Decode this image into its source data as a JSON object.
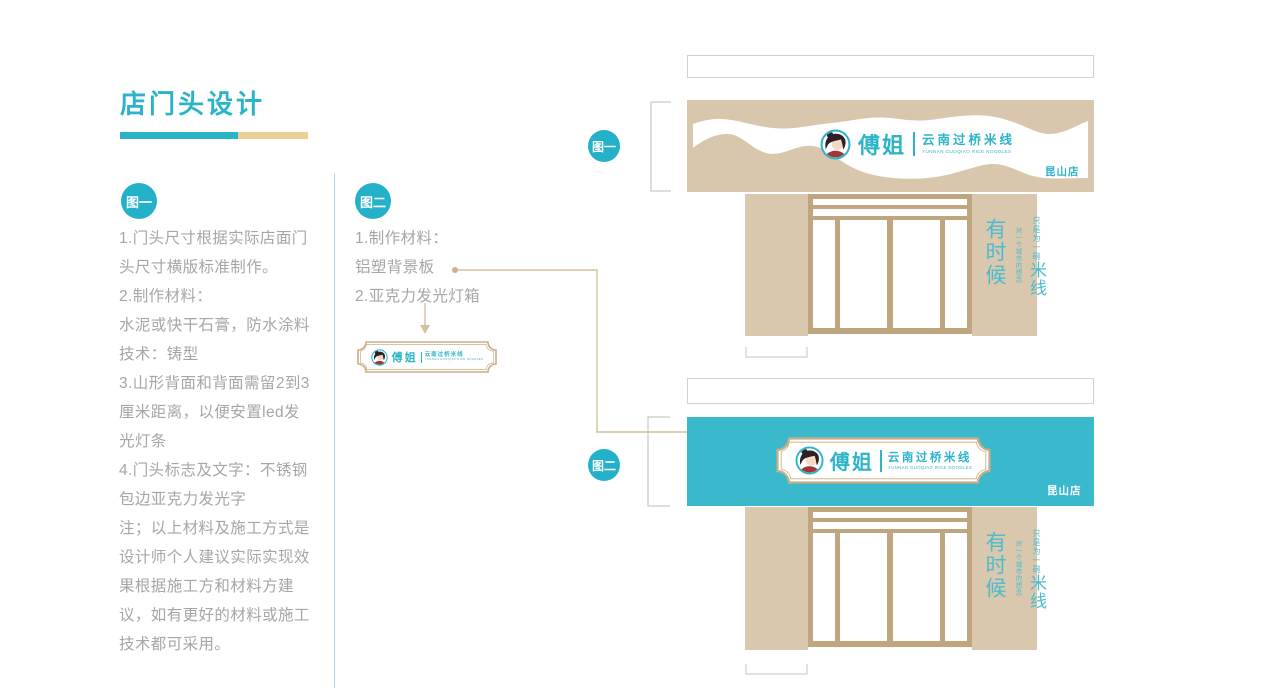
{
  "page": {
    "title": "店门头设计"
  },
  "palette": {
    "teal": "#2db4c9",
    "sign_teal": "#3ab9cd",
    "tan": "#d8c6ad",
    "frame_tan": "#bfa67e",
    "sand": "#ecd093",
    "note_gray": "#a6a6a6",
    "plaque_border": "#c9ad85"
  },
  "figure1": {
    "badge": "图一",
    "notes": "1.门头尺寸根据实际店面门\n头尺寸横版标准制作。\n2.制作材料：\n水泥或快干石膏，防水涂料\n技术：铸型\n3.山形背面和背面需留2到3\n厘米距离，以便安置led发\n光灯条\n4.门头标志及文字：不锈钢\n包边亚克力发光字\n注；以上材料及施工方式是\n设计师个人建议实际实现效\n果根据施工方和材料方建\n议，如有更好的材料或施工\n技术都可采用。"
  },
  "figure2": {
    "badge": "图二",
    "notes": "1.制作材料：\n铝塑背景板\n2.亚克力发光灯箱"
  },
  "brand": {
    "name": "傅姐",
    "tagline": "云南过桥米线",
    "tagline_en": "YUNNAN GUOQIAO RICE NOODLES",
    "store": "昆山店"
  },
  "slogan": {
    "opening": "有时候",
    "line_small": "只是为一碗",
    "line_emphasis": "米线",
    "line_secondary": "对一个城市的想念"
  }
}
